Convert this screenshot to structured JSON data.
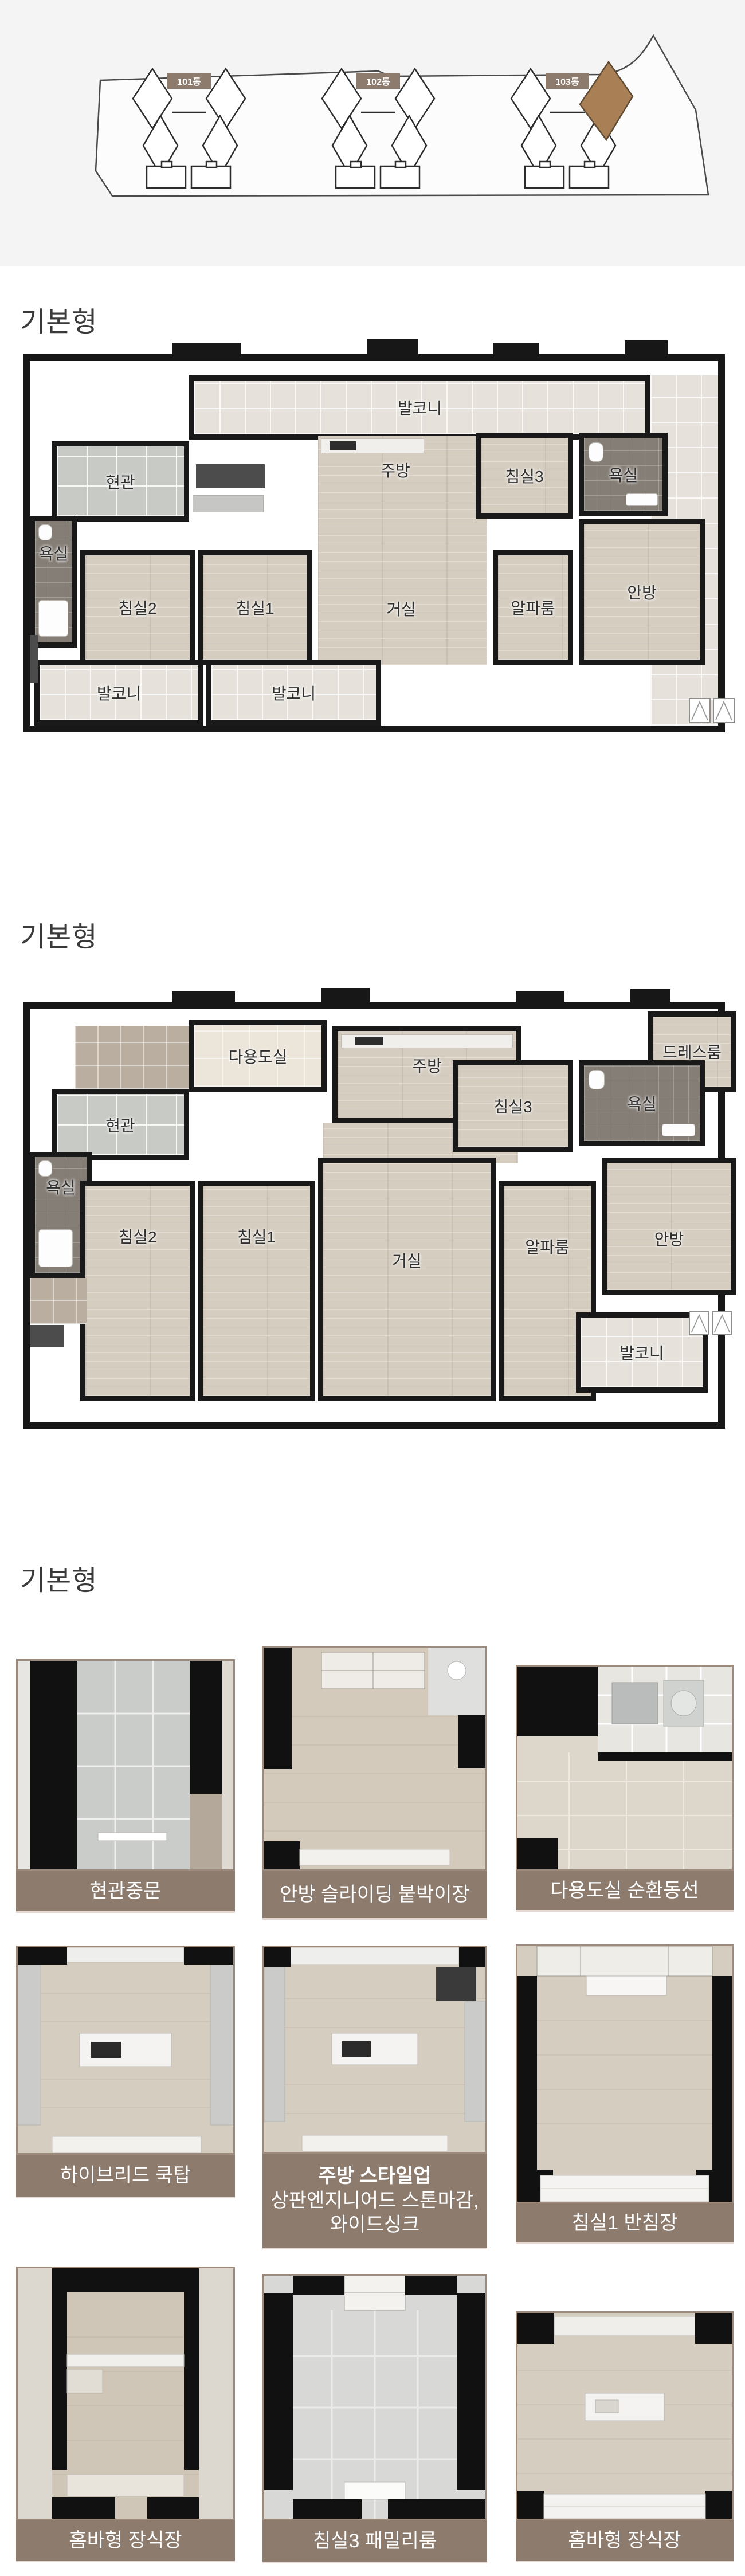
{
  "site_plan": {
    "buildings": [
      {
        "label": "101동"
      },
      {
        "label": "102동"
      },
      {
        "label": "103동"
      }
    ],
    "label_bg": "#8d7c6e",
    "label_text_color": "#ffffff",
    "highlight_color": "#a97f55",
    "highlighted_building": "103동"
  },
  "sections": [
    {
      "title": "기본형"
    },
    {
      "title": "기본형"
    },
    {
      "title": "기본형"
    }
  ],
  "plan1": {
    "rooms": [
      {
        "label": "발코니"
      },
      {
        "label": "현관"
      },
      {
        "label": "주방"
      },
      {
        "label": "침실3"
      },
      {
        "label": "욕실"
      },
      {
        "label": "욕실"
      },
      {
        "label": "침실2"
      },
      {
        "label": "침실1"
      },
      {
        "label": "거실"
      },
      {
        "label": "알파룸"
      },
      {
        "label": "안방"
      },
      {
        "label": "발코니"
      },
      {
        "label": "발코니"
      }
    ]
  },
  "plan2": {
    "rooms": [
      {
        "label": "다용도실"
      },
      {
        "label": "주방"
      },
      {
        "label": "드레스룸"
      },
      {
        "label": "현관"
      },
      {
        "label": "욕실"
      },
      {
        "label": "침실3"
      },
      {
        "label": "욕실"
      },
      {
        "label": "침실2"
      },
      {
        "label": "침실1"
      },
      {
        "label": "거실"
      },
      {
        "label": "알파룸"
      },
      {
        "label": "안방"
      },
      {
        "label": "발코니"
      }
    ]
  },
  "gallery": {
    "caption_bg": "#8d7c6e",
    "tiles": [
      {
        "caption": "현관중문"
      },
      {
        "caption": "안방 슬라이딩 붙박이장"
      },
      {
        "caption": "다용도실 순환동선"
      },
      {
        "caption": "하이브리드 쿡탑"
      },
      {
        "caption_title": "주방 스타일업",
        "caption_line2": "상판엔지니어드 스톤마감,",
        "caption_line3": "와이드싱크"
      },
      {
        "caption": "침실1 반침장"
      },
      {
        "caption": "홈바형 장식장"
      },
      {
        "caption": "침실3 패밀리룸"
      },
      {
        "caption": "홈바형 장식장"
      }
    ]
  }
}
